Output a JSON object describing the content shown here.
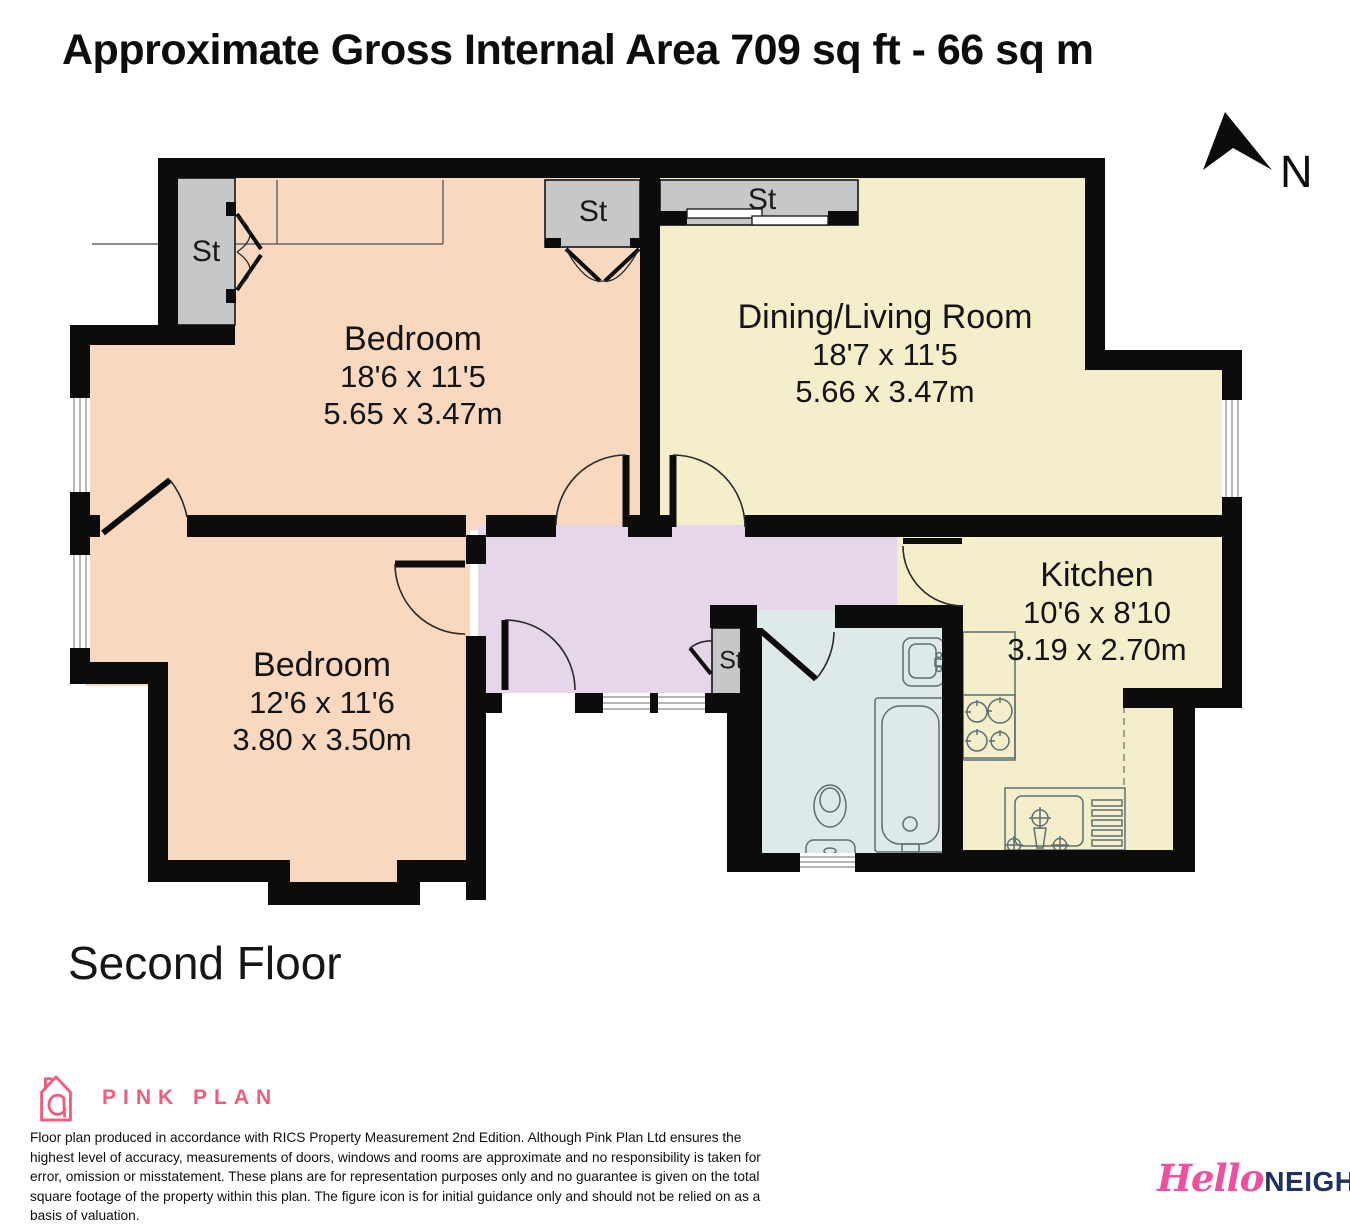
{
  "title": "Approximate Gross Internal Area 709 sq ft - 66 sq m",
  "floor_label": "Second Floor",
  "compass": {
    "label": "N"
  },
  "rooms": [
    {
      "id": "bedroom-1",
      "name": "Bedroom",
      "dims_imperial": "18'6 x 11'5",
      "dims_metric": "5.65 x 3.47m"
    },
    {
      "id": "dining-living-room",
      "name": "Dining/Living Room",
      "dims_imperial": "18'7 x 11'5",
      "dims_metric": "5.66 x 3.47m"
    },
    {
      "id": "bedroom-2",
      "name": "Bedroom",
      "dims_imperial": "12'6 x 11'6",
      "dims_metric": "3.80 x 3.50m"
    },
    {
      "id": "kitchen",
      "name": "Kitchen",
      "dims_imperial": "10'6 x 8'10",
      "dims_metric": "3.19 x 2.70m"
    }
  ],
  "storage": {
    "labels": [
      "St",
      "St",
      "St",
      "St"
    ]
  },
  "branding": {
    "producer_name": "PINK PLAN",
    "agency_name_script": "Hello",
    "agency_name_caps": "NEIGHBOUR"
  },
  "disclaimer": "Floor plan produced in accordance with RICS Property Measurement 2nd Edition. Although Pink Plan Ltd ensures the highest level of accuracy, measurements of doors, windows and rooms are approximate and no responsibility is taken for error, omission or misstatement. These plans are for representation purposes only and no guarantee is given on the total square footage of the property within this plan. The figure icon is for initial guidance only and should not be relied on as a basis of valuation.",
  "colors": {
    "wall": "#0c0c0c",
    "bedroom_fill": "#f8d8be",
    "living_fill": "#f4eecb",
    "hallway_fill": "#e6d6ea",
    "bathroom_fill": "#deeae9",
    "storage_fill": "#c6c7c9",
    "producer_pink": "#ef5d7c",
    "agency_pink": "#ee4fa0",
    "agency_navy": "#203064"
  }
}
